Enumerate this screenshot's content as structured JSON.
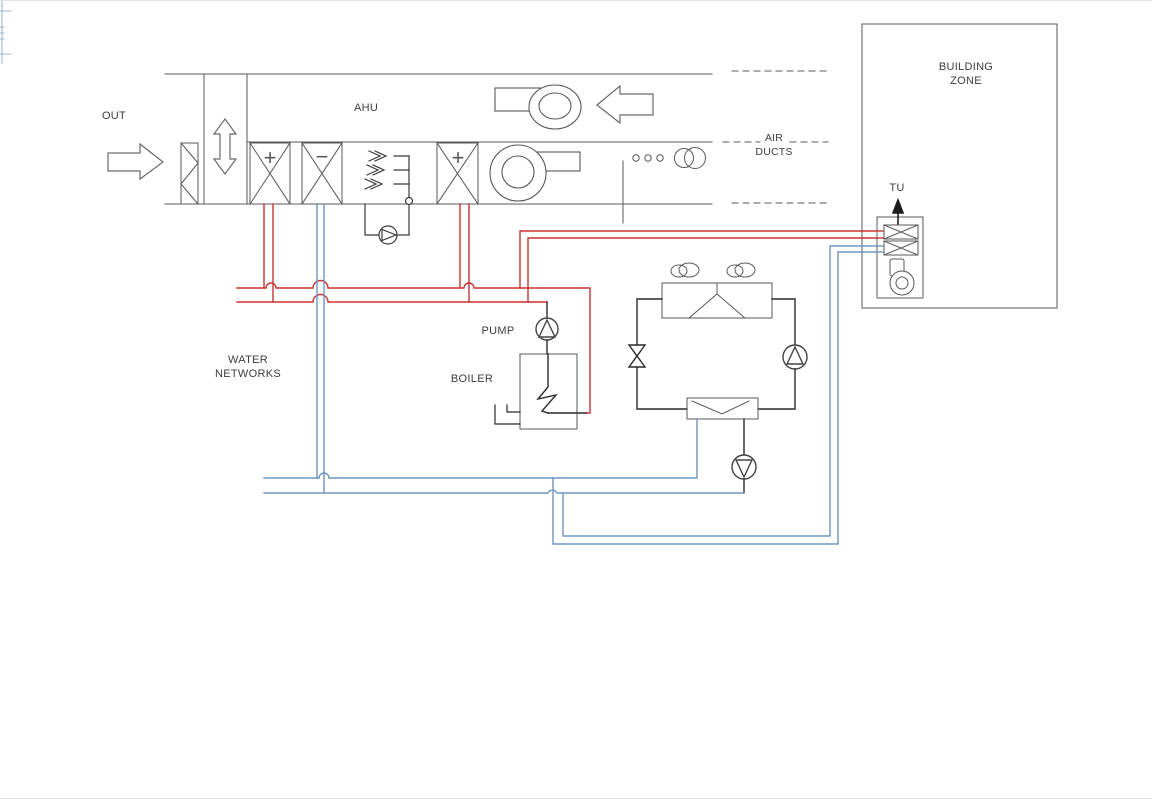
{
  "page": {
    "background": "#ffffff"
  },
  "diagram": {
    "labels": {
      "out": "OUT",
      "ahu": "AHU",
      "air_ducts": {
        "line1": "AIR",
        "line2": "DUCTS"
      },
      "building_zone": {
        "line1": "BUILDING",
        "line2": "ZONE"
      },
      "tu": "TU",
      "pump": "PUMP",
      "boiler": "BOILER",
      "water_networks": {
        "line1": "WATER",
        "line2": "NETWORKS"
      }
    },
    "coil_signs": {
      "heating_coil": "+",
      "cooling_coil": "−",
      "reheat_coil": "+"
    },
    "colors": {
      "line_gray": "#585858",
      "text": "#3d3d3d",
      "hot_water_red": "#c83230",
      "chilled_water_blue": "#6f95c1",
      "equipment_black": "#2a2a2a"
    }
  }
}
